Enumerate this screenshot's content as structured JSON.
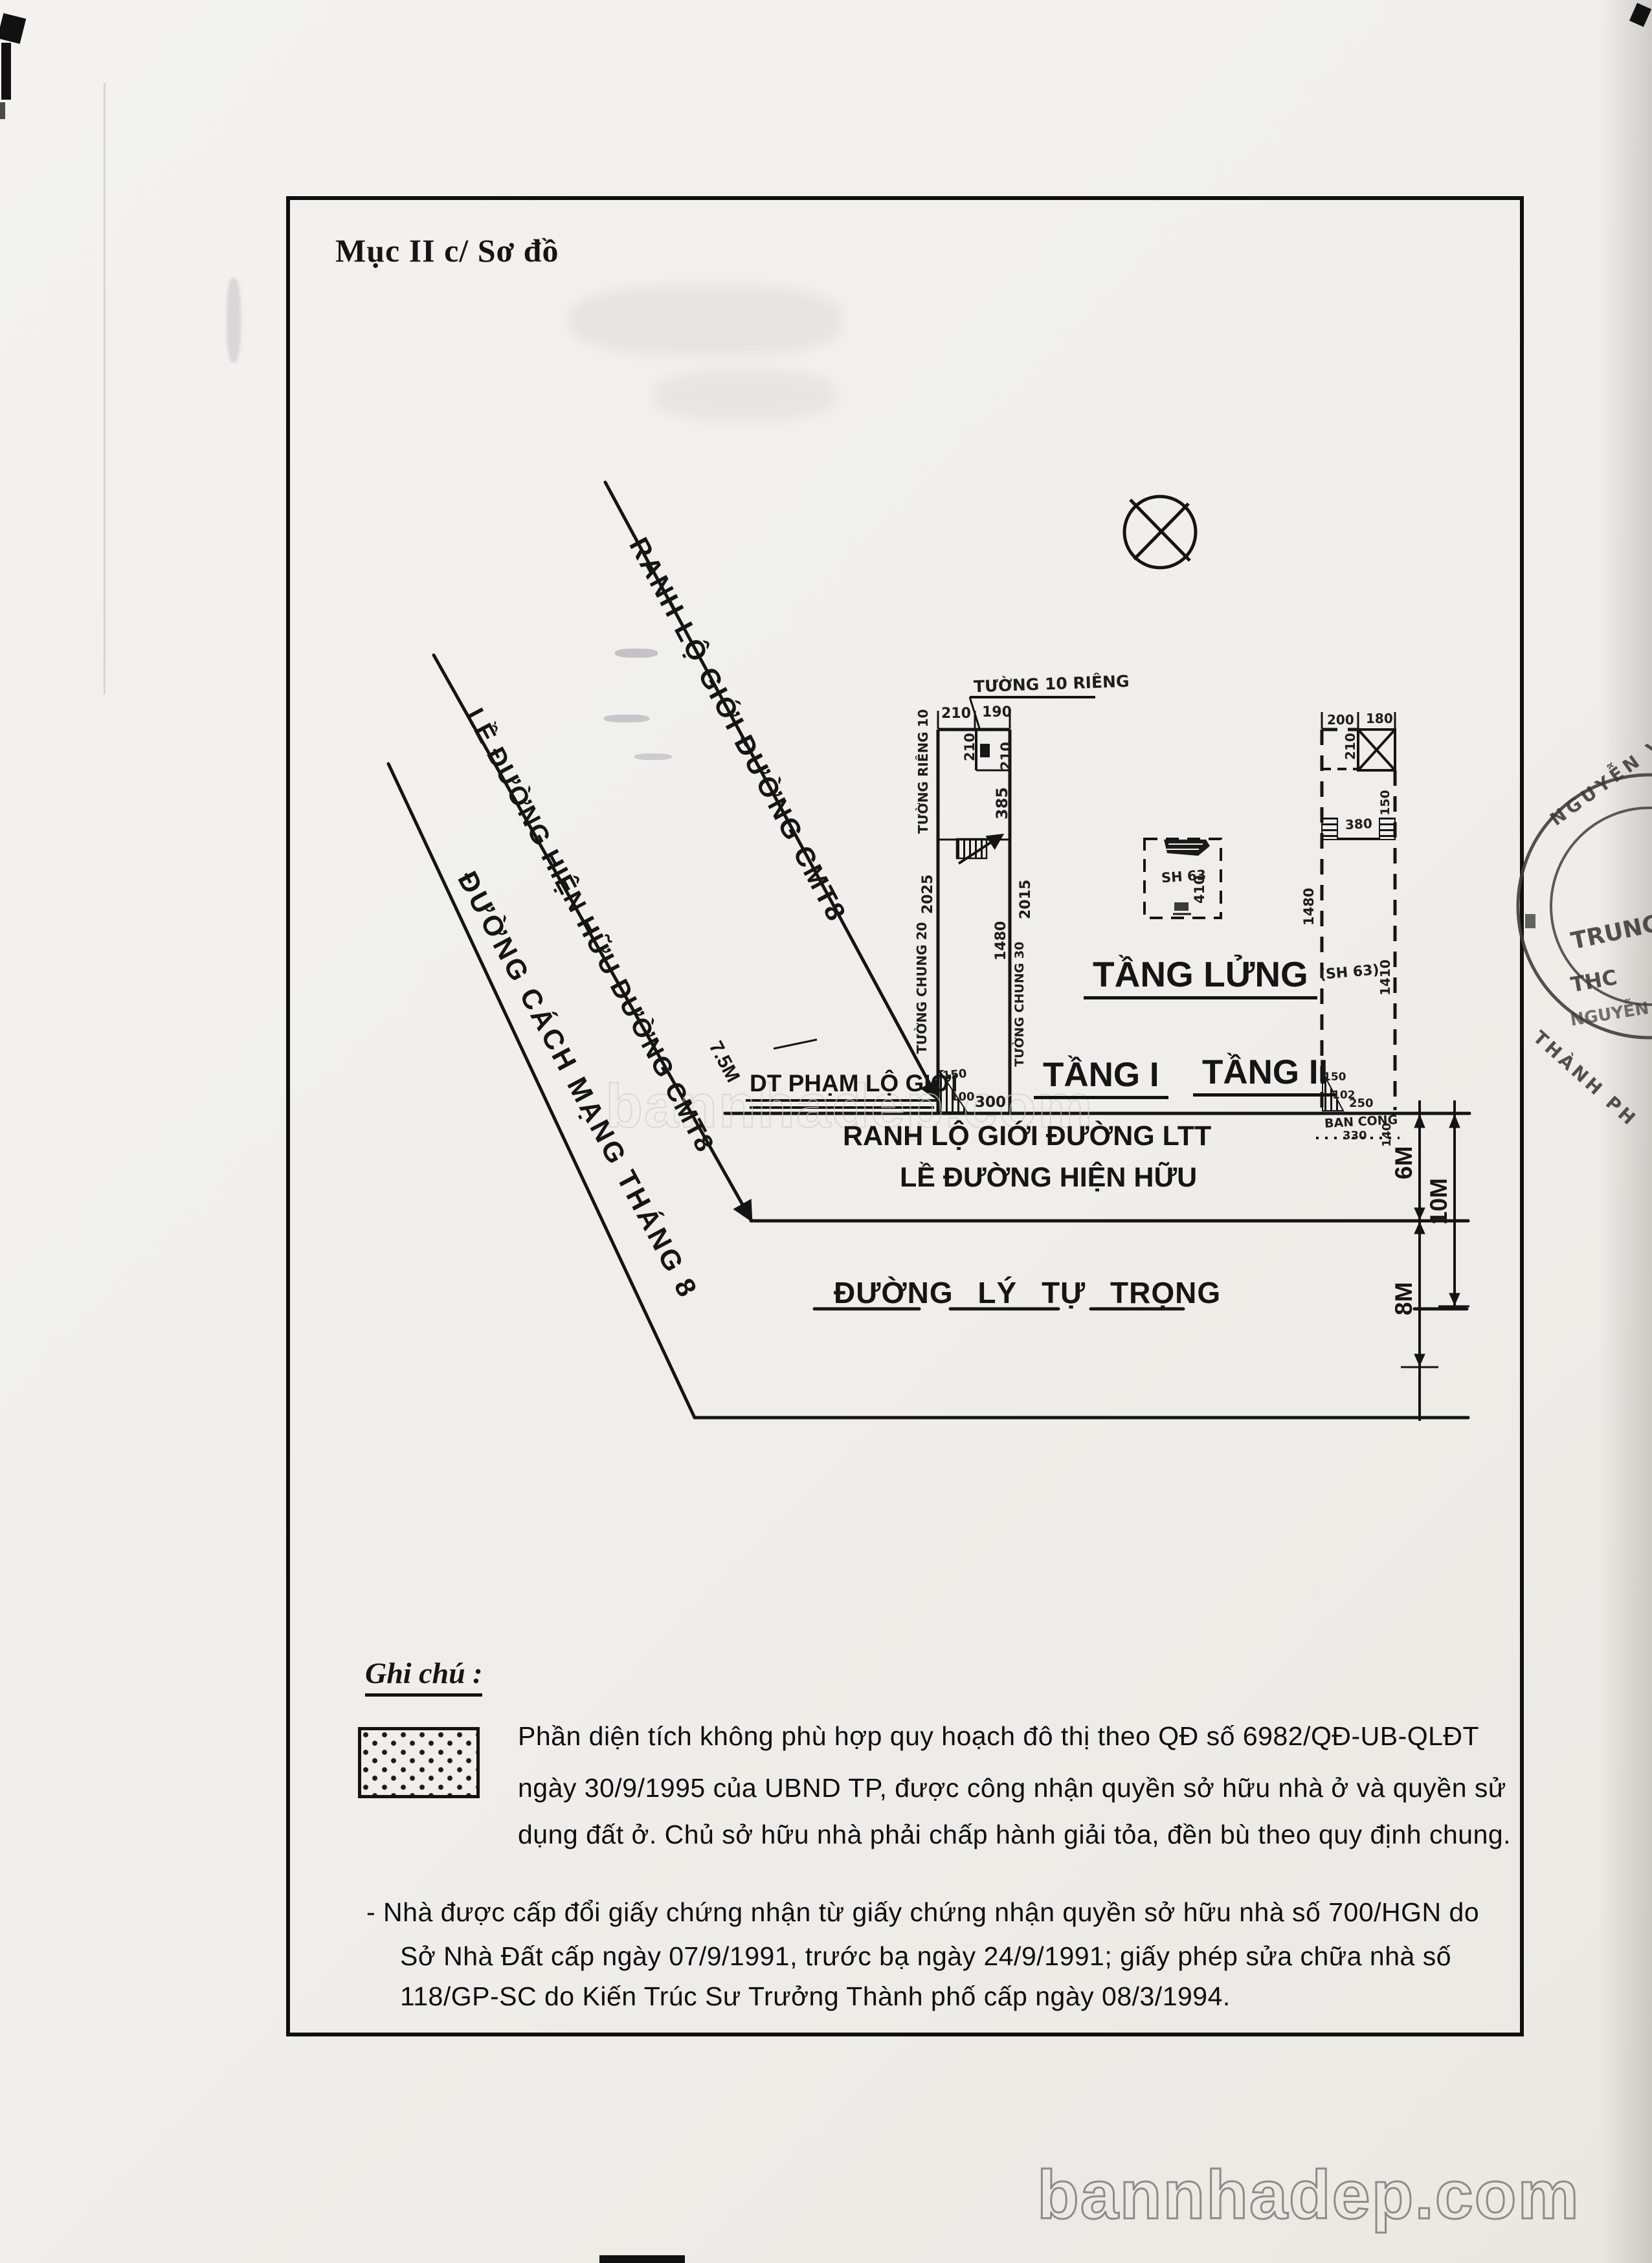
{
  "title": "Mục II c/ Sơ đồ",
  "diagram": {
    "road_labels": {
      "cmt8_boundary": "RANH LỘ GIỚI ĐƯỜNG CMT8",
      "cmt8_sidewalk": "LỀ ĐƯỜNG HIỆN HỮU ĐƯỜNG CMT8",
      "cmt8_road": "ĐƯỜNG CÁCH MẠNG THÁNG 8",
      "violation_area": "DT PHẠM LỘ GIỚI",
      "ltt_boundary": "RANH LỘ GIỚI ĐƯỜNG LTT",
      "ltt_sidewalk": "LỀ ĐƯỜNG HIỆN HỮU",
      "ltt_road": "ĐƯỜNG LÝ TỰ TRỌNG"
    },
    "measures": {
      "setback": "7.5M",
      "sidewalk_width": "6M",
      "boundary_width": "10M",
      "road_width": "8M"
    },
    "floor_labels": {
      "floor1": "TẦNG I",
      "mezzanine": "TẦNG LỬNG",
      "floor2": "TẦNG II"
    },
    "floor1_plan": {
      "top_wall_note": "TƯỜNG 10 RIÊNG",
      "dim_top_left": "210",
      "dim_top_right": "190",
      "dim_inner_v": "210",
      "dim_right_upper": "210",
      "dim_right_entry": "385",
      "left_wall_note_upper": "TƯỜNG RIÊNG 10",
      "left_dim": "2025",
      "left_wall_note_lower": "TƯỜNG CHUNG 20",
      "right_dim": "1480",
      "right_wall_note": "TƯỜNG CHUNG 30",
      "right_outer_dim": "2015",
      "corner_dim_a": "150",
      "corner_dim_b": "100",
      "bottom_dim": "300"
    },
    "mezzanine_plan": {
      "note": "SH 63",
      "dim": "410"
    },
    "floor2_plan": {
      "dim_top_left": "200",
      "dim_top_right": "180",
      "dim_inner": "210",
      "dim_right_upper": "150",
      "dim_mid": "380",
      "left_dim": "1480",
      "note": "(SH 63)",
      "right_dim": "1410",
      "corner_dim_a": "150",
      "corner_dim_b": "102",
      "corner_dim_c": "250",
      "balcony_note": "BAN CÔNG",
      "balcony_dim_a": "330",
      "balcony_dim_b": "140"
    }
  },
  "notes": {
    "heading": "Ghi chú :",
    "paragraph1": [
      "Phần diện tích không phù hợp quy hoạch đô thị theo QĐ số 6982/QĐ-UB-QLĐT",
      "ngày 30/9/1995 của UBND TP, được công nhận quyền sở hữu nhà ở và quyền sử",
      "dụng đất ở. Chủ sở hữu nhà phải chấp hành giải tỏa, đền bù theo quy định chung."
    ],
    "paragraph2": [
      "- Nhà được cấp đổi giấy chứng nhận từ giấy chứng nhận quyền sở hữu nhà  số 700/HGN do",
      "Sở Nhà Đất cấp ngày 07/9/1991, trước bạ  ngày 24/9/1991; giấy phép sửa chữa nhà số",
      "118/GP-SC do Kiến Trúc Sư Trưởng Thành phố cấp ngày 08/3/1994."
    ]
  },
  "stamp": {
    "ring_top": "NGUYỄN VĂ",
    "center1": "TRUNG T",
    "center2": "THC",
    "center3": "NGUYỄN",
    "ring_bottom": "THÀNH PH"
  },
  "watermark": {
    "text": "bannhadep.com"
  },
  "colors": {
    "ink": "#141414",
    "paper": "#f1f0ec",
    "stamp_ink": "#3c3b39",
    "watermark_gray": "#8e8c89"
  }
}
